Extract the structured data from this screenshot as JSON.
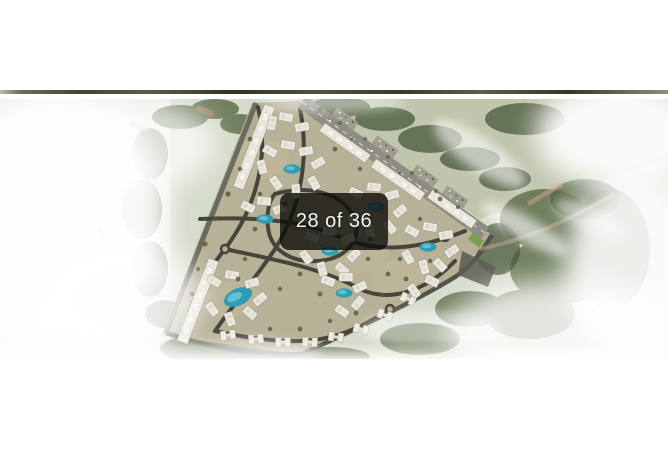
{
  "viewer": {
    "counter": {
      "text": "28 of 36",
      "current": 28,
      "total": 36
    },
    "colors": {
      "badge_background": "#0d0c09",
      "badge_text": "#f4f4f2"
    }
  },
  "photo": {
    "alt": "Aerial master plan rendering of a residential compound with white villas and apartment slabs, looping internal roads, turquoise pools and lagoons, surrounded by green forest and drifting white clouds",
    "colors": {
      "pool": "#2e9cb2",
      "forest": "#55643f",
      "road": "#45453c",
      "terrain": "#b5ae93",
      "fog": "#ffffff"
    }
  }
}
